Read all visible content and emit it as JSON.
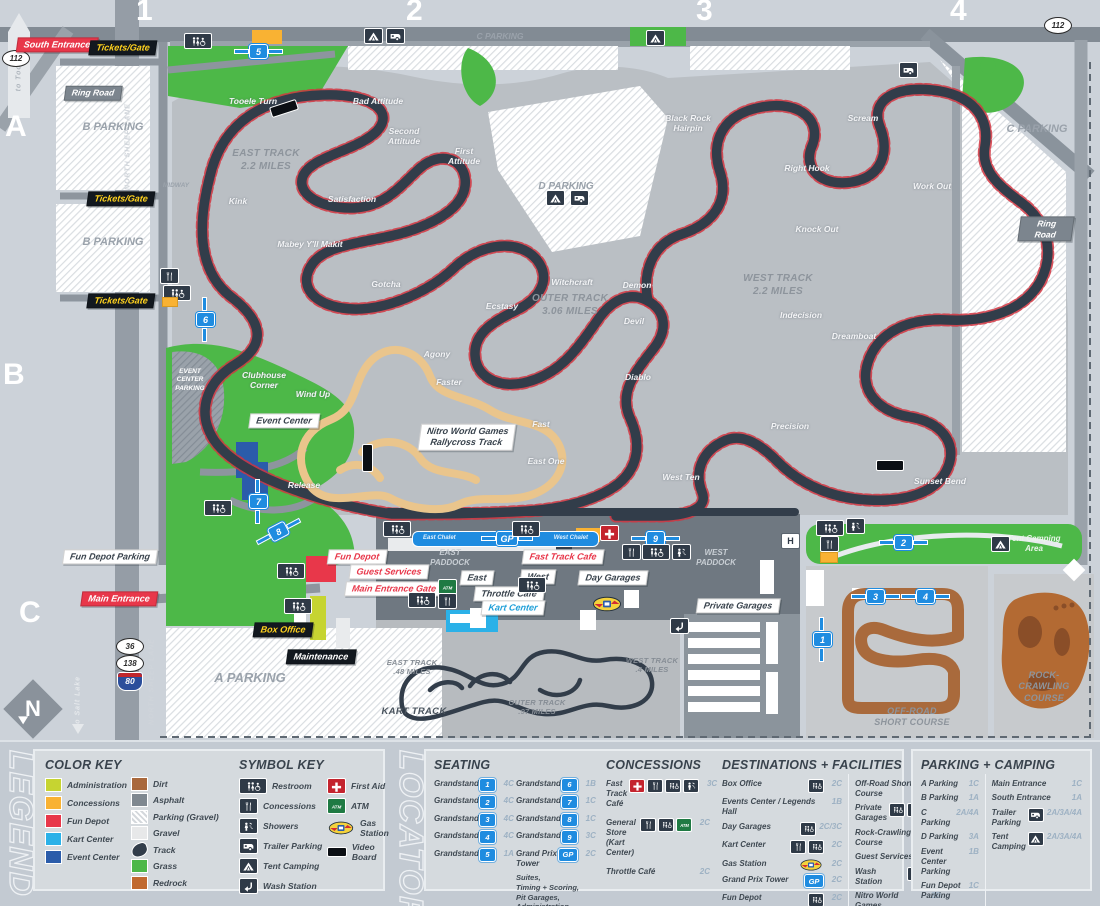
{
  "map": {
    "grid_cols": [
      "1",
      "2",
      "3",
      "4"
    ],
    "grid_rows": [
      "A",
      "B",
      "C"
    ],
    "roads": {
      "to_tooele": "to Tooele",
      "route_112_left": "112",
      "route_112_right": "112",
      "ring_road_left": "Ring Road",
      "ring_road_right": "Ring Road",
      "midway": "MIDWAY",
      "north_sheep_lane_top": "NORTH SHEEP LANE",
      "north_sheep_lane_bottom": "NORTH SHEEP LANE",
      "to_salt_lake": "to Salt Lake",
      "route_36": "36",
      "route_138": "138",
      "route_80": "80",
      "north": "N"
    },
    "tags": {
      "south_entrance": "South Entrance",
      "tickets_gate": "Tickets/Gate",
      "main_entrance": "Main Entrance",
      "event_center": "Event Center",
      "nitro": "Nitro World Games\nRallycross Track",
      "fun_depot": "Fun Depot",
      "guest_services": "Guest Services",
      "main_entrance_gate": "Main Entrance Gate",
      "fast_track_cafe": "Fast Track Cafe",
      "throttle_cafe": "Throttle Café",
      "kart_center": "Kart Center",
      "east": "East",
      "west": "West",
      "day_garages": "Day Garages",
      "private_garages": "Private Garages",
      "box_office": "Box Office",
      "maintenance": "Maintenance",
      "fun_depot_parking": "Fun Depot Parking",
      "east_chalet": "East Chalet",
      "west_chalet": "West Chalet"
    },
    "areas": {
      "b_parking": "B PARKING",
      "a_parking": "A PARKING",
      "c_parking": "C PARKING",
      "d_parking": "D PARKING",
      "east_paddock": "EAST\nPADDOCK",
      "west_paddock": "WEST\nPADDOCK",
      "event_center_parking": "EVENT\nCENTER\nPARKING",
      "tent_camping_area": "Tent Camping\nArea",
      "off_road": "OFF-ROAD\nSHORT COURSE",
      "rock_crawling": "ROCK-CRAWLING\nCOURSE",
      "kart_track": "KART TRACK"
    },
    "tracks": {
      "east": "EAST TRACK\n2.2 MILES",
      "outer": "OUTER TRACK\n3.06 MILES",
      "west": "WEST TRACK\n2.2 MILES",
      "kart_east": "EAST TRACK\n.48 MILES",
      "kart_outer": "OUTER TRACK\n.97 MILES",
      "kart_west": "WEST TRACK\n.4 MILES"
    },
    "corners": [
      "Tooele Turn",
      "Bad Attitude",
      "Second\nAttitude",
      "First\nAttitude",
      "Satisfaction",
      "Kink",
      "Mabey Y'll Makit",
      "Gotcha",
      "Witchcraft",
      "Ecstasy",
      "Agony",
      "Faster",
      "Clubhouse\nCorner",
      "Wind Up",
      "Release",
      "Fast",
      "East One",
      "West Ten",
      "Demon",
      "Devil",
      "Diablo",
      "Black Rock\nHairpin",
      "Scream",
      "Right Hook",
      "Work Out",
      "Knock Out",
      "Indecision",
      "Dreamboat",
      "Precision",
      "Sunset Bend"
    ],
    "markers": {
      "gs1": "1",
      "gs2": "2",
      "gs3": "3",
      "gs4": "4",
      "gs5": "5",
      "gs6": "6",
      "gs7": "7",
      "gs8": "8",
      "gs9": "9",
      "gp": "GP",
      "helipad": "H"
    }
  },
  "legend": {
    "panel_title": "LEGEND",
    "color_key": {
      "title": "COLOR KEY",
      "col1": [
        {
          "label": "Administration",
          "color": "#c6d431"
        },
        {
          "label": "Concessions",
          "color": "#f9b233"
        },
        {
          "label": "Fun Depot",
          "color": "#e8374a"
        },
        {
          "label": "Kart Center",
          "color": "#2bb1e8"
        },
        {
          "label": "Event Center",
          "color": "#2b5caa"
        }
      ],
      "col2": [
        {
          "label": "Dirt",
          "color": "#a9683c"
        },
        {
          "label": "Asphalt",
          "color": "#7f8890"
        },
        {
          "label": "Parking (Gravel)",
          "color": "hatch"
        },
        {
          "label": "Gravel",
          "color": "#e7e8e9"
        },
        {
          "label": "Track",
          "color": "#323d4a"
        },
        {
          "label": "Grass",
          "color": "#4db848"
        },
        {
          "label": "Redrock",
          "color": "#c1692f"
        }
      ]
    },
    "symbol_key": {
      "title": "SYMBOL KEY",
      "col1": [
        {
          "label": "Restroom",
          "icon": "restroom-icon"
        },
        {
          "label": "Concessions",
          "icon": "concessions-icon"
        },
        {
          "label": "Showers",
          "icon": "showers-icon"
        },
        {
          "label": "Trailer Parking",
          "icon": "trailer-icon"
        },
        {
          "label": "Tent Camping",
          "icon": "tent-icon"
        },
        {
          "label": "Wash Station",
          "icon": "wash-icon"
        }
      ],
      "col2": [
        {
          "label": "First Aid",
          "icon": "first-aid-icon"
        },
        {
          "label": "ATM",
          "icon": "atm-icon"
        },
        {
          "label": "Gas Station",
          "icon": "gas-icon"
        },
        {
          "label": "Video Board",
          "icon": "video-board-icon"
        }
      ]
    }
  },
  "locator": {
    "panel_title": "LOCATOR",
    "seating": {
      "title": "SEATING",
      "col1": [
        {
          "label": "Grandstand",
          "num": "1",
          "loc": "4C"
        },
        {
          "label": "Grandstand",
          "num": "2",
          "loc": "4C"
        },
        {
          "label": "Grandstand",
          "num": "3",
          "loc": "4C"
        },
        {
          "label": "Grandstand",
          "num": "4",
          "loc": "4C"
        },
        {
          "label": "Grandstand",
          "num": "5",
          "loc": "1A"
        }
      ],
      "col2": [
        {
          "label": "Grandstand",
          "num": "6",
          "loc": "1B"
        },
        {
          "label": "Grandstand",
          "num": "7",
          "loc": "1C"
        },
        {
          "label": "Grandstand",
          "num": "8",
          "loc": "1C"
        },
        {
          "label": "Grandstand",
          "num": "9",
          "loc": "3C"
        },
        {
          "label": "Grand Prix\nTower",
          "num": "GP",
          "loc": "2C",
          "sub": "Suites,\nTiming + Scoring,\nPit Garages,\nAdministration,\nEast Chalet, West Chalet"
        }
      ]
    },
    "concessions": {
      "title": "CONCESSIONS",
      "items": [
        {
          "label": "Fast Track\nCafé",
          "loc": "3C"
        },
        {
          "label": "General Store\n(Kart Center)",
          "loc": "2C"
        },
        {
          "label": "Throttle Café",
          "loc": "2C"
        }
      ]
    },
    "destinations": {
      "title": "DESTINATIONS + FACILITIES",
      "col1": [
        {
          "label": "Box Office",
          "loc": "2C"
        },
        {
          "label": "Events Center / Legends Hall",
          "loc": "1B"
        },
        {
          "label": "Day Garages",
          "loc": "2C/3C"
        },
        {
          "label": "Kart Center",
          "loc": "2C"
        },
        {
          "label": "Gas Station",
          "loc": "2C"
        },
        {
          "label": "Grand Prix Tower",
          "loc": "2C"
        },
        {
          "label": "Fun Depot",
          "loc": "2C"
        }
      ],
      "col2": [
        {
          "label": "Off-Road Short Course",
          "loc": "4C"
        },
        {
          "label": "Private Garages",
          "loc": "3C"
        },
        {
          "label": "Rock-Crawling Course",
          "loc": "4C"
        },
        {
          "label": "Guest Services",
          "loc": "2C"
        },
        {
          "label": "Wash Station",
          "loc": "3C"
        },
        {
          "label": "Nitro World Games\nRallycross Track",
          "loc": "2B"
        }
      ]
    },
    "parking": {
      "title": "PARKING + CAMPING",
      "col1": [
        {
          "label": "A Parking",
          "loc": "1C"
        },
        {
          "label": "B Parking",
          "loc": "1A"
        },
        {
          "label": "C Parking",
          "loc": "2A/4A"
        },
        {
          "label": "D Parking",
          "loc": "3A"
        },
        {
          "label": "Event Center\nParking",
          "loc": "1B"
        },
        {
          "label": "Fun Depot\nParking",
          "loc": "1C"
        }
      ],
      "col2": [
        {
          "label": "Main Entrance",
          "loc": "1C"
        },
        {
          "label": "South Entrance",
          "loc": "1A"
        },
        {
          "label": "Trailer Parking",
          "loc": "2A/3A/4A"
        },
        {
          "label": "Tent Camping",
          "loc": "2A/3A/4A"
        }
      ]
    }
  }
}
